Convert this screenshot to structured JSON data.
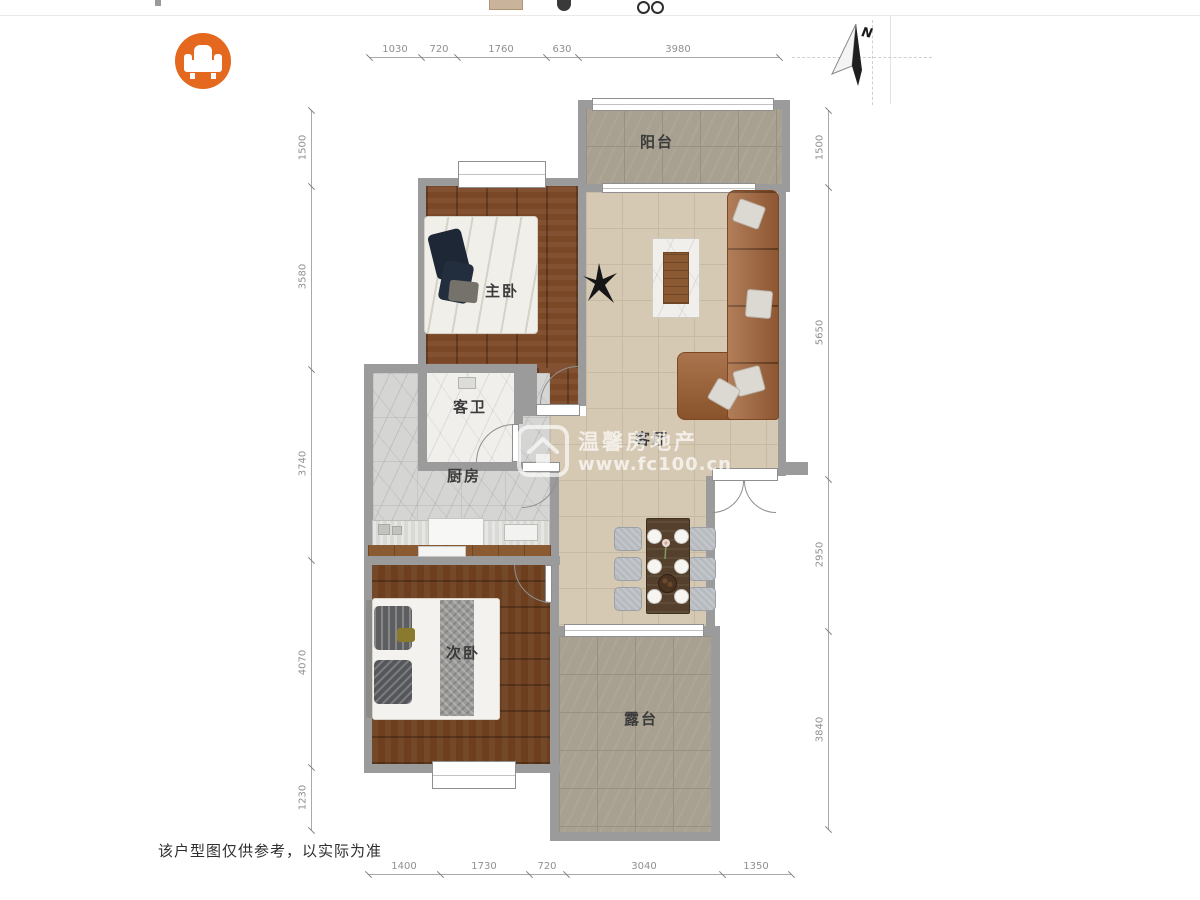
{
  "header": {
    "logo_icon": "armchair",
    "accent_color": "#e4681e"
  },
  "compass": {
    "north_label": "N"
  },
  "rooms": {
    "balcony": {
      "label": "阳台"
    },
    "master_bedroom": {
      "label": "主卧"
    },
    "guest_bathroom": {
      "label": "客卫"
    },
    "kitchen": {
      "label": "厨房"
    },
    "living_room": {
      "label": "客厅"
    },
    "second_bedroom": {
      "label": "次卧"
    },
    "terrace": {
      "label": "露台"
    }
  },
  "dims": {
    "top": [
      "1030",
      "720",
      "1760",
      "630",
      "3980"
    ],
    "left": [
      "1500",
      "3580",
      "3740",
      "4070",
      "1230"
    ],
    "right": [
      "1500",
      "5650",
      "2950",
      "3840"
    ],
    "bottom": [
      "1400",
      "1730",
      "720",
      "3040",
      "1350"
    ]
  },
  "watermark": {
    "title": "温馨房地产",
    "url": "www.fc100.cn"
  },
  "footer": {
    "disclaimer": "该户型图仅供参考，以实际为准"
  }
}
